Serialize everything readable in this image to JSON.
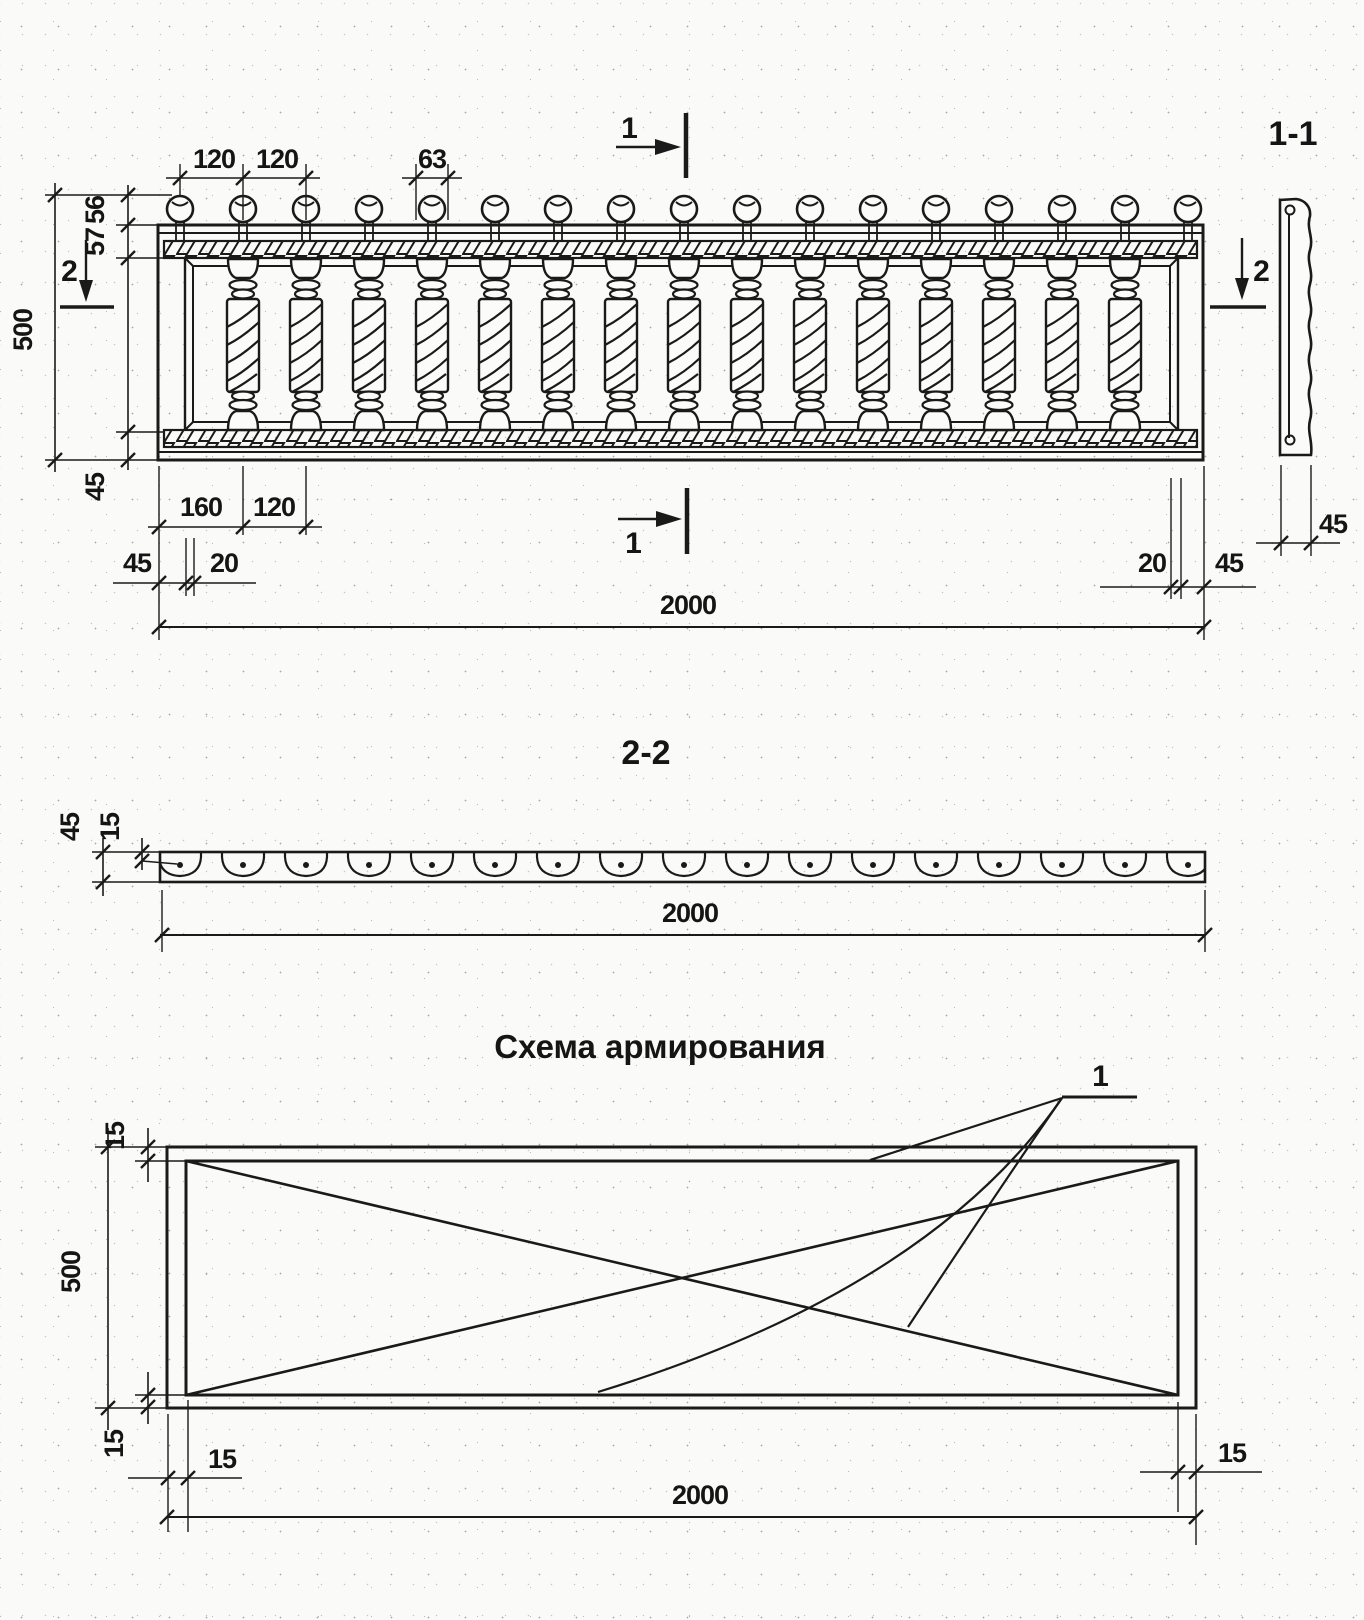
{
  "drawing": {
    "elevation": {
      "top_dims": {
        "spacing_a": "120",
        "spacing_b": "120",
        "shaft_width": "63"
      },
      "left_dims": {
        "knob_height": "56",
        "rail_height": "57",
        "total_height": "500",
        "bottom_rail": "45"
      },
      "bottom_dims": {
        "first_offset": "160",
        "spacing": "120",
        "left_margin": "45",
        "left_inset": "20",
        "right_inset": "20",
        "right_margin": "45",
        "overall_width": "2000"
      },
      "section_marks": {
        "mark_1_top": "1",
        "mark_1_bottom": "1",
        "mark_2_left": "2",
        "mark_2_right": "2"
      },
      "finial_count": 17,
      "baluster_count": 15
    },
    "section_1_1": {
      "title": "1-1",
      "profile_width": "45"
    },
    "section_2_2": {
      "title": "2-2",
      "strip_height": "45",
      "flange": "15",
      "overall_width": "2000",
      "socket_count": 17
    },
    "reinforcement": {
      "title": "Схема армирования",
      "bar_callout": "1",
      "cover_top": "15",
      "height": "500",
      "cover_bottom": "15",
      "cover_left": "15",
      "cover_right": "15",
      "overall_width": "2000"
    }
  }
}
